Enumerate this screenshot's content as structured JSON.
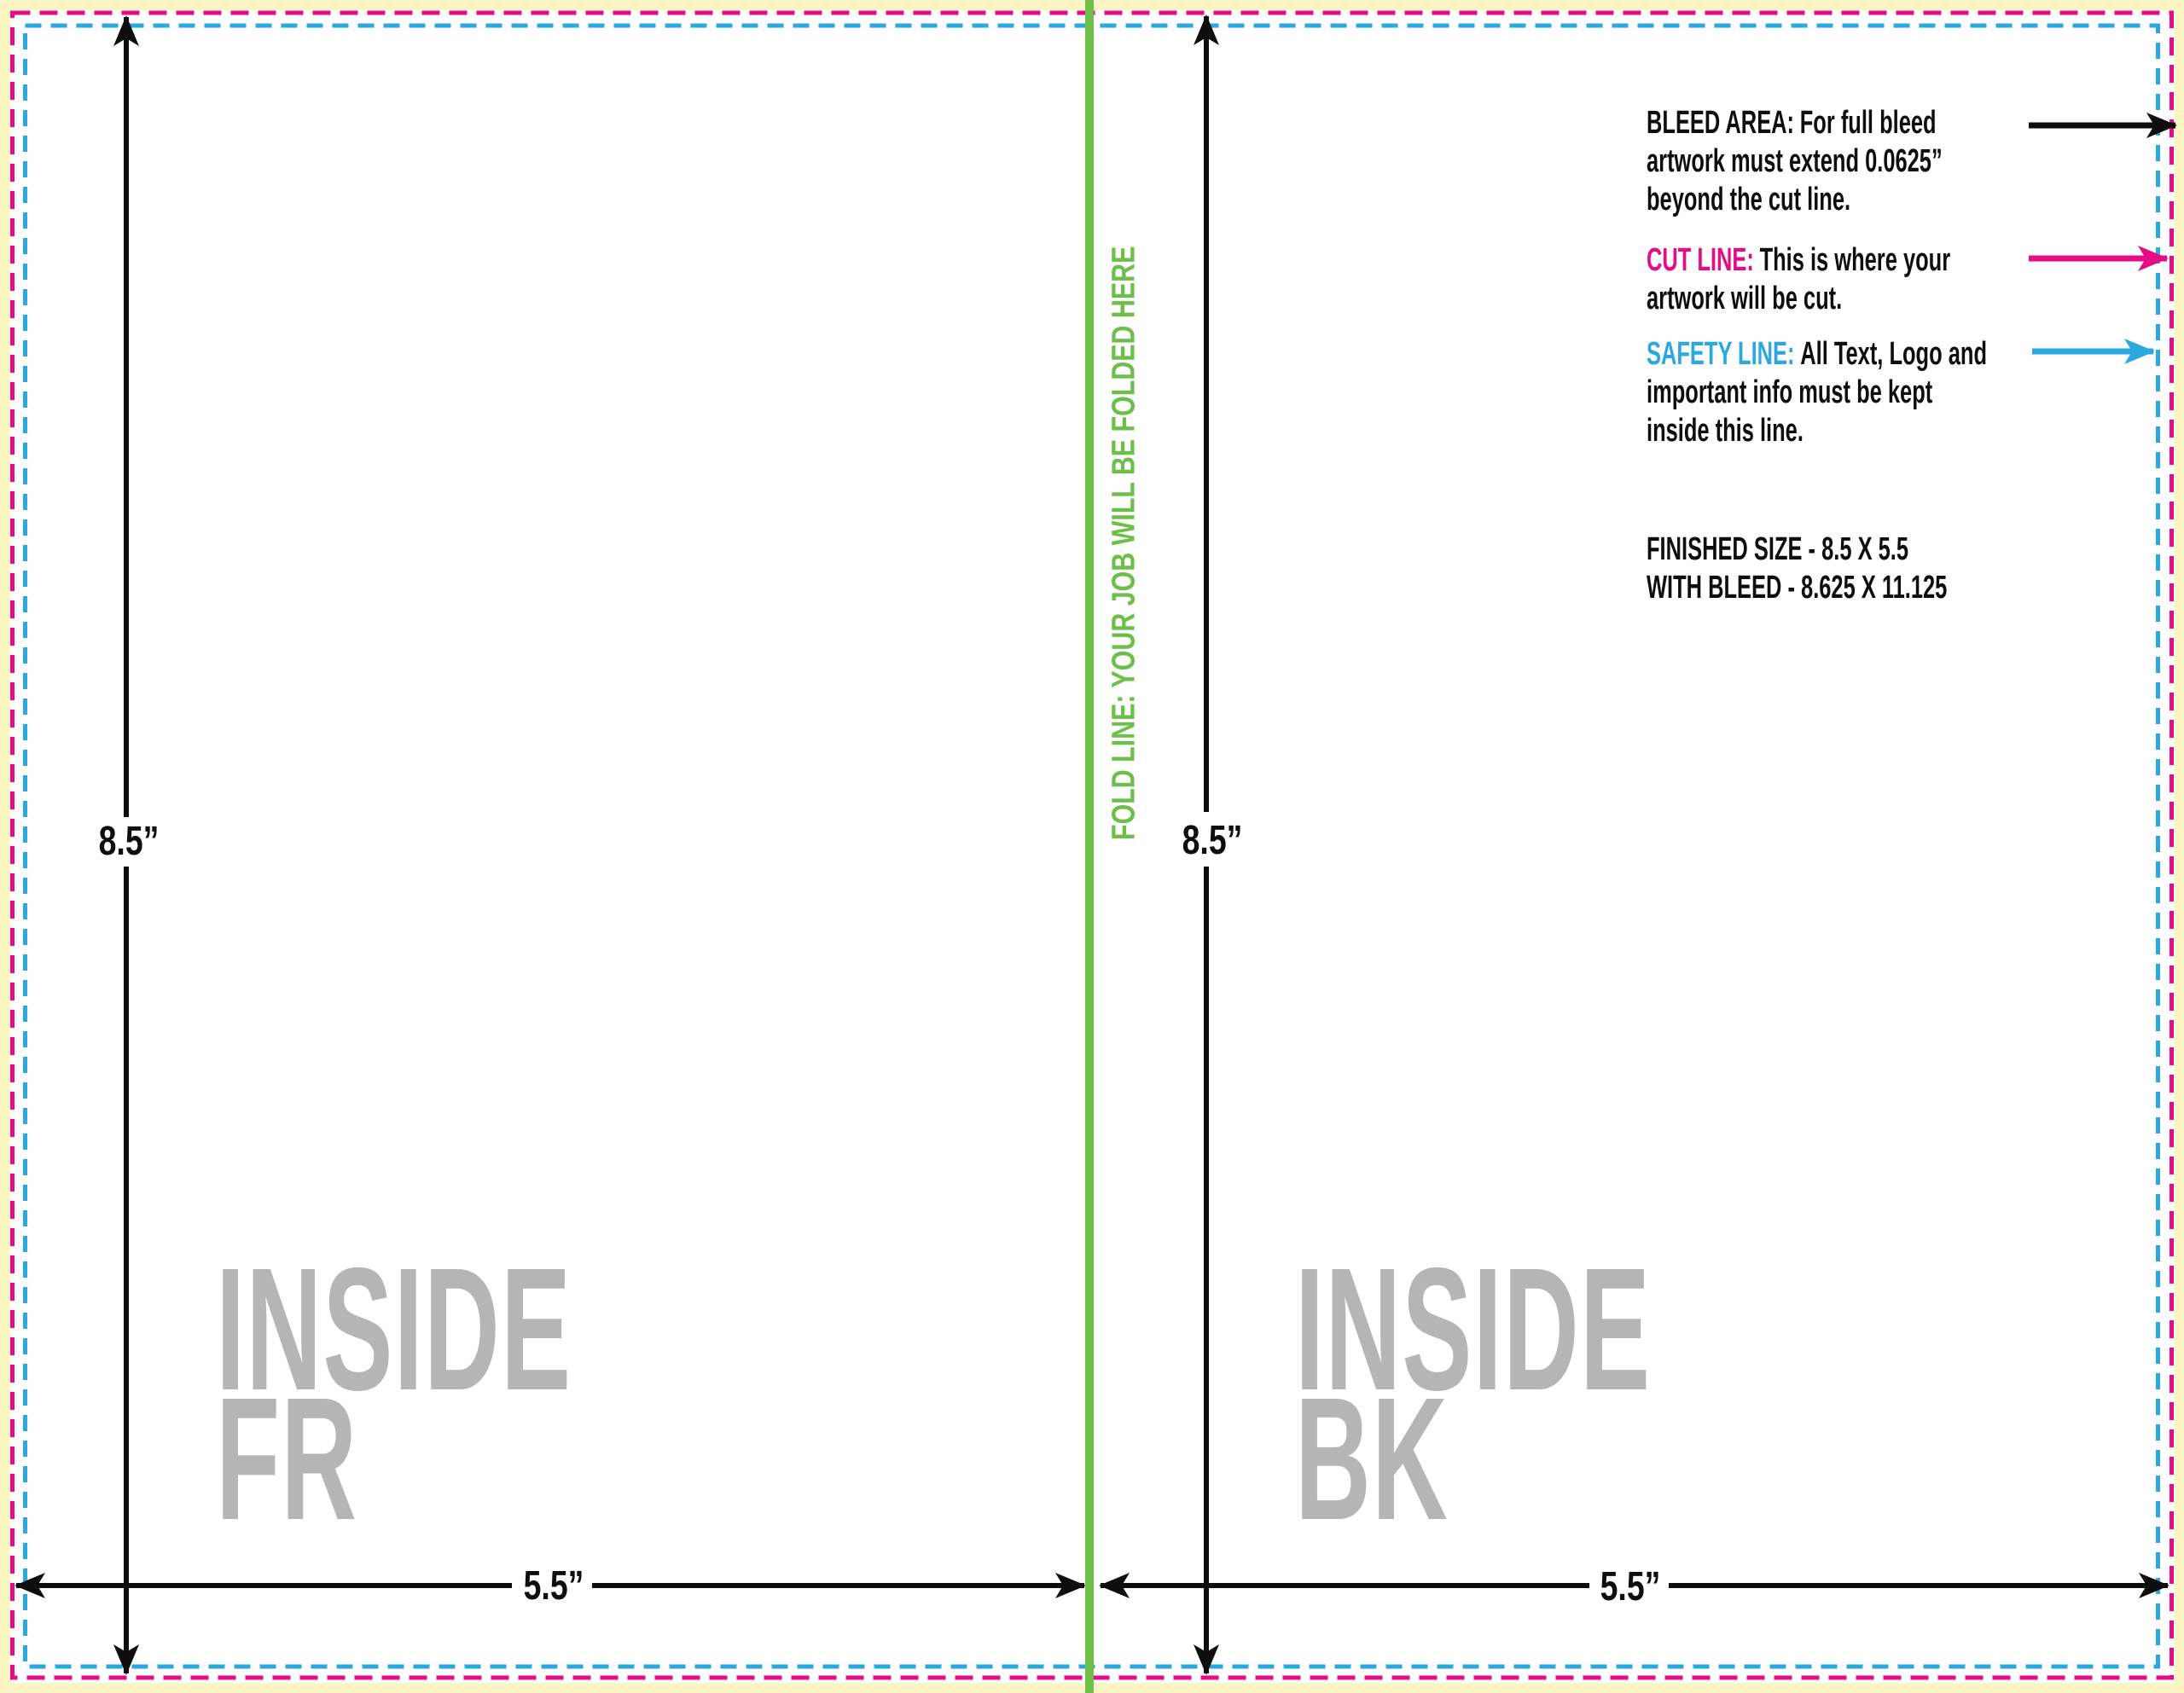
{
  "legend": {
    "bleed": {
      "label": "BLEED AREA:",
      "text_line1": "For full bleed",
      "text_line2": "artwork must extend 0.0625”",
      "text_line3": "beyond the cut line."
    },
    "cut": {
      "label": "CUT LINE:",
      "text_line1": "This is where your",
      "text_line2": "artwork will be cut."
    },
    "safety": {
      "label": "SAFETY LINE:",
      "text_line1": "All Text, Logo and",
      "text_line2": "important info must be kept",
      "text_line3": "inside this line."
    }
  },
  "sizes": {
    "finished": "FINISHED SIZE - 8.5 X 5.5",
    "with_bleed": "WITH BLEED - 8.625 X 11.125"
  },
  "dimensions": {
    "panel_height_left": "8.5”",
    "panel_height_right": "8.5”",
    "panel_width_left": "5.5”",
    "panel_width_right": "5.5”"
  },
  "fold_line": {
    "text": "FOLD LINE: YOUR JOB WILL BE FOLDED HERE"
  },
  "panels": {
    "inside_front": {
      "line1": "INSIDE",
      "line2": "FR"
    },
    "inside_back": {
      "line1": "INSIDE",
      "line2": "BK"
    }
  },
  "colors": {
    "bleed_yellow": "#fcf5c3",
    "cut_pink": "#e60c86",
    "safety_blue": "#2ba8df",
    "fold_green": "#6dbf49",
    "watermark_gray": "#b5b5b5",
    "line_black": "#0e0e0e"
  }
}
